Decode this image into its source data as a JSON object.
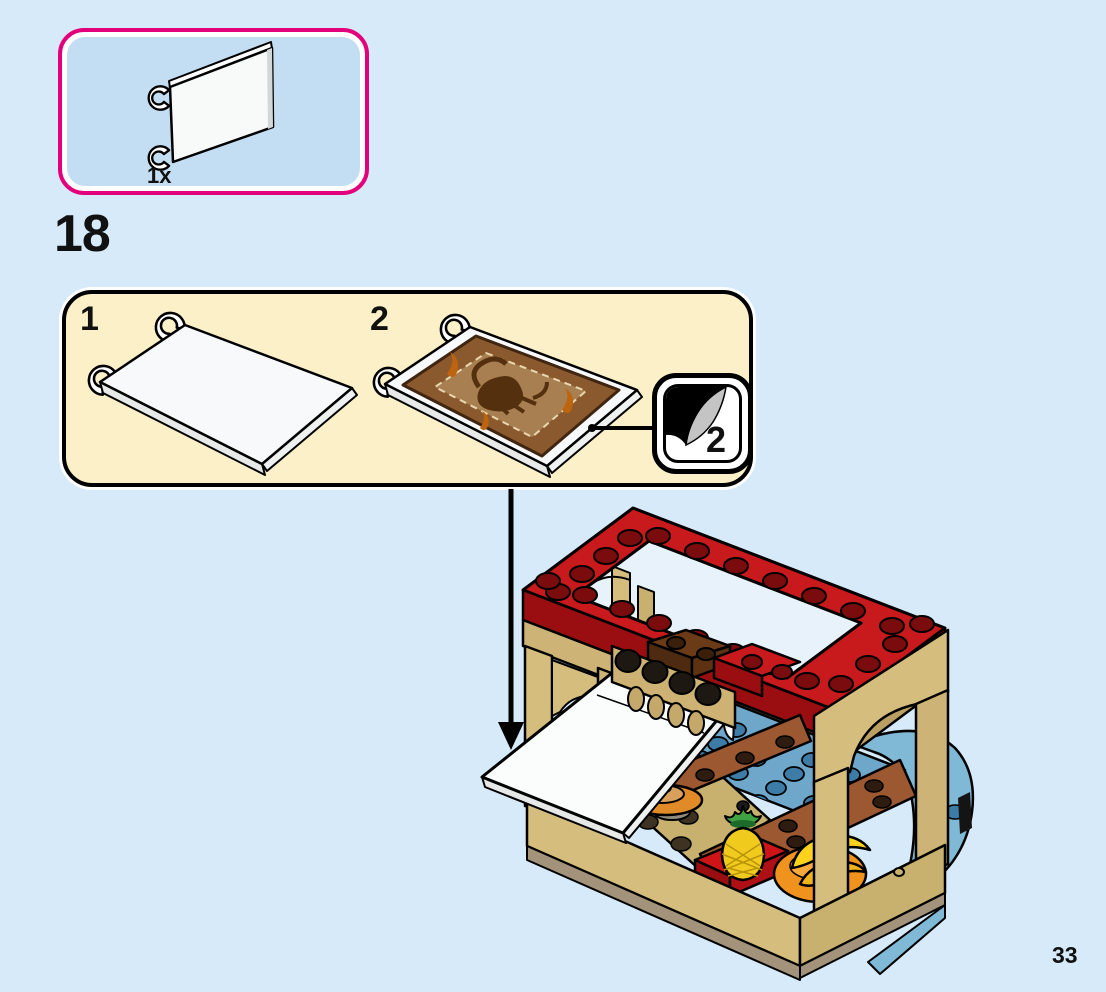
{
  "page": {
    "number": "33",
    "background_color": "#D7EAF9"
  },
  "step": {
    "number": "18"
  },
  "parts_callout": {
    "count_label": "1x",
    "piece": "white-flag-6x4-with-clips",
    "border_color": "#E3007B",
    "fill_color": "#C3DDF2"
  },
  "assembly_panel": {
    "background_color": "#FBF0C8",
    "substeps": [
      {
        "label": "1",
        "piece": "white-flag-6x4-with-clips"
      },
      {
        "label": "2",
        "piece": "white-flag-6x4-with-boar-pattern-sticker"
      }
    ],
    "sticker_callout": {
      "number": "2",
      "icon": "peeling-sticker-icon"
    }
  },
  "assembly_arrow": {
    "icon": "down-arrow-icon",
    "color": "#000000"
  },
  "model": {
    "name": "fruit-stall-canopy-on-boat",
    "parts_shown": [
      "red-canopy-frame",
      "tan-arches",
      "flag-hinge-assembly",
      "white-flag",
      "blue-deck-plates",
      "brown-planks",
      "pancake-dish",
      "red-plate",
      "pineapple",
      "banana-bunch",
      "orange-bowl",
      "boat-hull"
    ],
    "colors": {
      "red": "#C8191C",
      "dark_red": "#9A0E12",
      "tan": "#D5BD7E",
      "beam_tan": "#CDB476",
      "blue_plate": "#6FA7CB",
      "hull_blue": "#7FB9D6",
      "plank_brown": "#9C5830",
      "brick_brown": "#6B3A16",
      "pineapple_yellow": "#F0CB1E",
      "leaf_green": "#3FA344",
      "banana_yellow": "#FFD21C",
      "bowl_orange": "#F0921E",
      "flag_white": "#FBFCFC"
    }
  }
}
